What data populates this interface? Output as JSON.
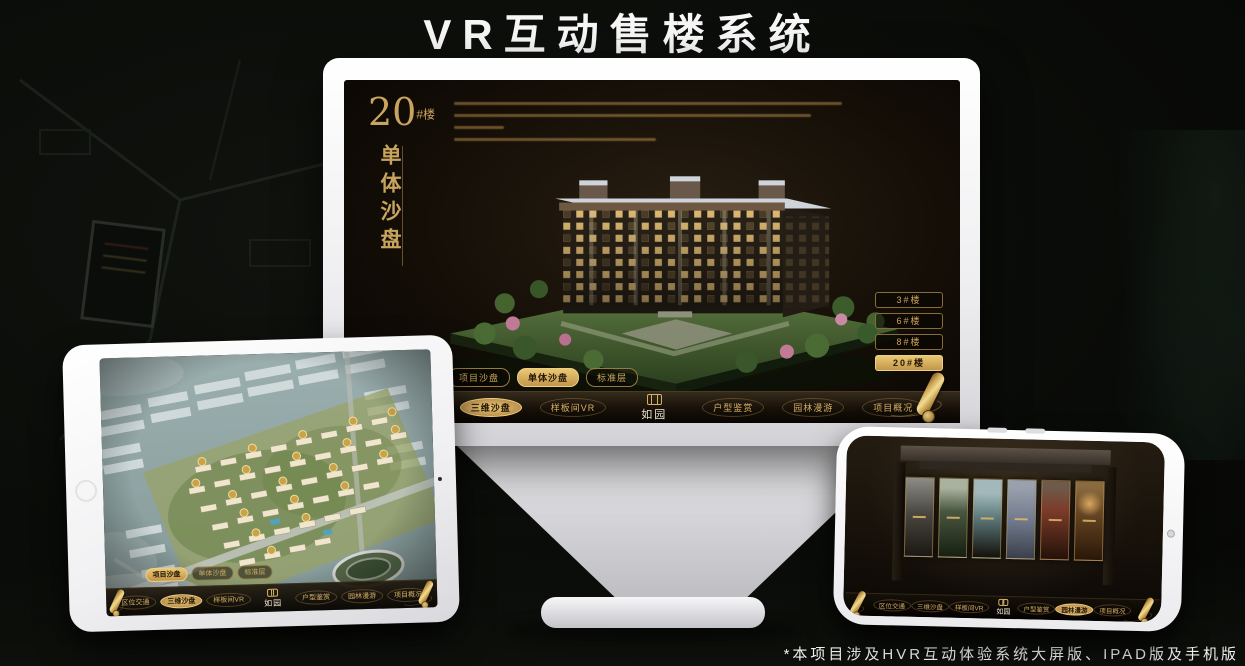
{
  "page": {
    "title": "VR互动售楼系统",
    "footnote": "*本项目涉及HVR互动体验系统大屏版、IPAD版及手机版"
  },
  "brand": {
    "name": "如园"
  },
  "colors": {
    "accent_gold": "#c9a45e",
    "selected_gold": "#eac873",
    "screen_background": "#14100a",
    "device_white": "#f2f2f4"
  },
  "icons": {
    "menu_handle": "scroll-icon",
    "brand_mark": "seal-icon"
  },
  "monitor": {
    "building_label": {
      "number": "20",
      "suffix": "#楼"
    },
    "section_title": "单体沙盘",
    "floor_buttons": [
      {
        "label": "3#楼",
        "selected": false
      },
      {
        "label": "6#楼",
        "selected": false
      },
      {
        "label": "8#楼",
        "selected": false
      },
      {
        "label": "20#楼",
        "selected": true
      }
    ],
    "view_tabs": [
      {
        "label": "项目沙盘",
        "selected": false
      },
      {
        "label": "单体沙盘",
        "selected": true
      },
      {
        "label": "标准层",
        "selected": false
      }
    ],
    "nav": {
      "left": [
        {
          "label": "区位交通",
          "selected": false
        },
        {
          "label": "三维沙盘",
          "selected": true
        },
        {
          "label": "样板间VR",
          "selected": false
        }
      ],
      "right": [
        {
          "label": "户型鉴赏",
          "selected": false
        },
        {
          "label": "园林漫游",
          "selected": false
        },
        {
          "label": "项目概况",
          "selected": false
        }
      ]
    }
  },
  "tablet": {
    "view_tabs": [
      {
        "label": "项目沙盘",
        "selected": true
      },
      {
        "label": "单体沙盘",
        "selected": false
      },
      {
        "label": "标准层",
        "selected": false
      }
    ],
    "nav": {
      "left": [
        {
          "label": "区位交通",
          "selected": false
        },
        {
          "label": "三维沙盘",
          "selected": true
        },
        {
          "label": "样板间VR",
          "selected": false
        }
      ],
      "right": [
        {
          "label": "户型鉴赏",
          "selected": false
        },
        {
          "label": "园林漫游",
          "selected": false
        },
        {
          "label": "项目概况",
          "selected": false
        }
      ]
    }
  },
  "phone": {
    "nav": {
      "left": [
        {
          "label": "区位交通",
          "selected": false
        },
        {
          "label": "三维沙盘",
          "selected": false
        },
        {
          "label": "样板间VR",
          "selected": false
        }
      ],
      "right": [
        {
          "label": "户型鉴赏",
          "selected": false
        },
        {
          "label": "园林漫游",
          "selected": true
        },
        {
          "label": "项目概况",
          "selected": false
        }
      ]
    }
  }
}
